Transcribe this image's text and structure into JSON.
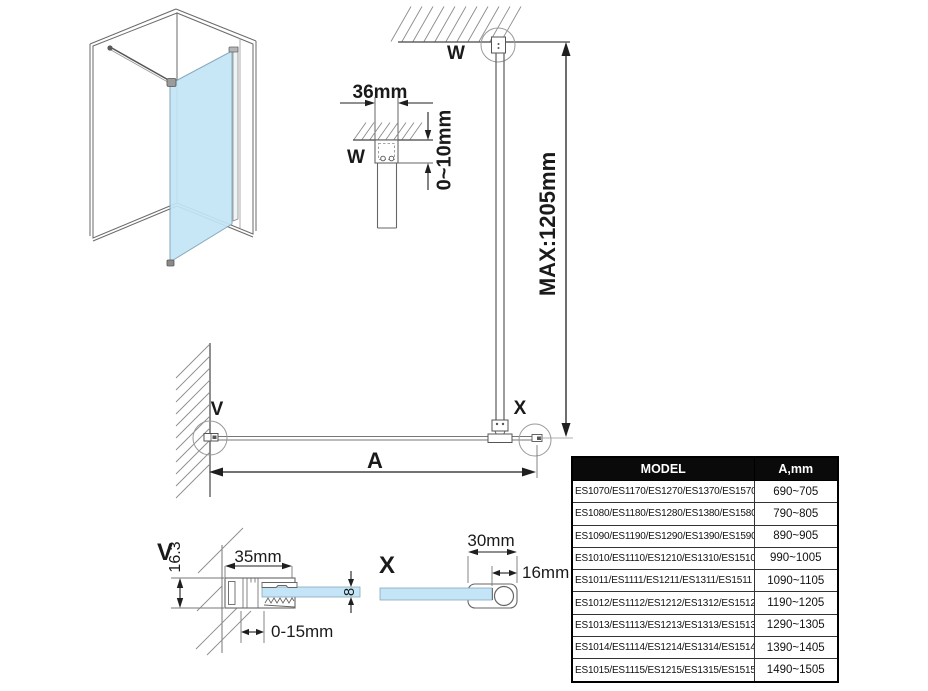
{
  "drawing": {
    "labels": {
      "w": "W",
      "v": "V",
      "x": "X",
      "a": "A"
    },
    "dims": {
      "bracket_width": "36mm",
      "ceiling_gap": "0~10mm",
      "bar_max": "MAX:1205mm",
      "profile_width": "35mm",
      "profile_height": "16.3",
      "wall_adjust": "0-15mm",
      "glass_thickness": "8",
      "foot_width": "30mm",
      "foot_offset": "16mm"
    },
    "colors": {
      "glass": "#c3e5f7",
      "line_dark": "#1f1f1f",
      "line_mid": "#5f5f5f",
      "hatch": "#8c8c8c"
    }
  },
  "table": {
    "headers": {
      "model": "MODEL",
      "a": "A,mm"
    },
    "rows": [
      {
        "model": "ES1070/ES1170/ES1270/ES1370/ES1570",
        "a": "690~705"
      },
      {
        "model": "ES1080/ES1180/ES1280/ES1380/ES1580",
        "a": "790~805"
      },
      {
        "model": "ES1090/ES1190/ES1290/ES1390/ES1590",
        "a": "890~905"
      },
      {
        "model": "ES1010/ES1110/ES1210/ES1310/ES1510",
        "a": "990~1005"
      },
      {
        "model": "ES1011/ES1111/ES1211/ES1311/ES1511",
        "a": "1090~1105"
      },
      {
        "model": "ES1012/ES1112/ES1212/ES1312/ES1512",
        "a": "1190~1205"
      },
      {
        "model": "ES1013/ES1113/ES1213/ES1313/ES1513",
        "a": "1290~1305"
      },
      {
        "model": "ES1014/ES1114/ES1214/ES1314/ES1514",
        "a": "1390~1405"
      },
      {
        "model": "ES1015/ES1115/ES1215/ES1315/ES1515",
        "a": "1490~1505"
      }
    ]
  }
}
